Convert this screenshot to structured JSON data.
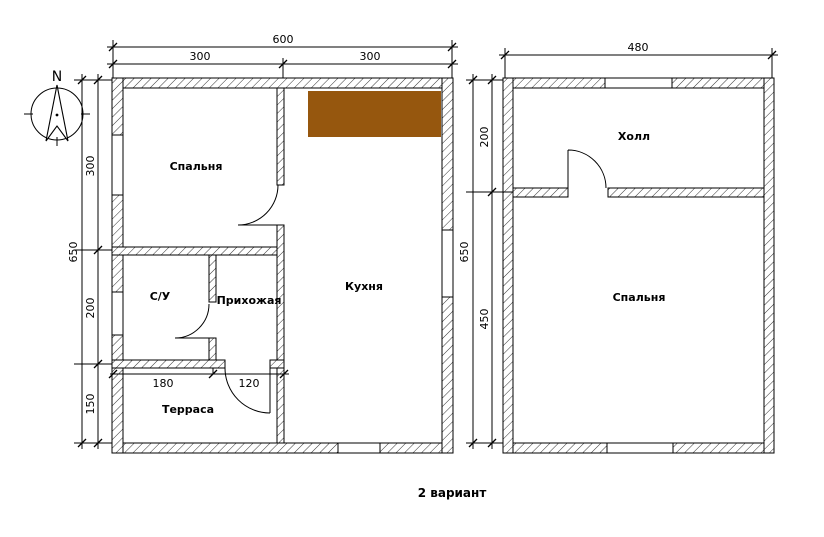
{
  "caption": "2 вариант",
  "compass": {
    "north_label": "N"
  },
  "colors": {
    "counter": "#96570E"
  },
  "plan_left": {
    "dim_top_total": "600",
    "dim_top_segments": [
      "300",
      "300"
    ],
    "dim_side_total": "650",
    "dim_side_segments": [
      "300",
      "200",
      "150"
    ],
    "dim_inner_segments": [
      "180",
      "120"
    ],
    "rooms": {
      "bedroom": "Спальня",
      "bathroom": "С/У",
      "hallway": "Прихожая",
      "kitchen": "Кухня",
      "terrace": "Терраса"
    }
  },
  "plan_right": {
    "dim_top_total": "480",
    "dim_side_total": "650",
    "dim_side_segments": [
      "200",
      "450"
    ],
    "rooms": {
      "hall": "Холл",
      "bedroom": "Спальня"
    }
  }
}
